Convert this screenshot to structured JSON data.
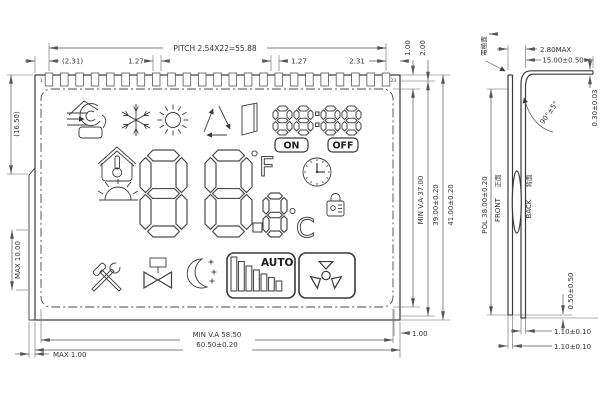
{
  "front": {
    "pins": {
      "first": "1",
      "last": "23",
      "count": 23
    },
    "dims": {
      "pitch": "PITCH 2.54X22=55.88",
      "left_margin": "(2.31)",
      "pin_left": "1.27",
      "pin_right": "1.27",
      "right_margin": "2.31",
      "top_gap": "1.00",
      "top_gap2": "2.00",
      "left_height": "(16.50)",
      "tab_height": "MAX 10.00",
      "tab_width": "MAX 1.00",
      "va_width": "MIN V.A 58.50",
      "outer_width": "60.50±0.20",
      "va_height": "MIN V.A 37.00",
      "glass_height": "39.00±0.20",
      "outer_height": "41.00±0.20",
      "right_gap": "1.00"
    },
    "display": {
      "time_digits": "88:88",
      "on": "ON",
      "off": "OFF",
      "main_digits": "88.8",
      "unit_f": "F",
      "unit_c": "C",
      "auto": "AUTO",
      "icons": [
        "heating",
        "snowflake",
        "sun",
        "recycle",
        "door",
        "house-temperature",
        "sunrise",
        "clock",
        "lock",
        "tools",
        "valve",
        "night",
        "auto-fan-bars",
        "fan"
      ]
    }
  },
  "side": {
    "electrode_label": "電極面",
    "front_cn": "正面",
    "front_en": "FRONT",
    "back_cn": "背面",
    "back_en": "BACK",
    "dims": {
      "stack": "2.80MAX",
      "pin_length": "15.00±0.50",
      "bend_angle": "90°±5°",
      "pin_thickness": "0.30±0.03",
      "pol_height": "POL 38.00±0.20",
      "pol_offset": "0.50±0.50",
      "glass_back": "1.10±0.10",
      "glass_front": "1.10±0.10"
    }
  }
}
